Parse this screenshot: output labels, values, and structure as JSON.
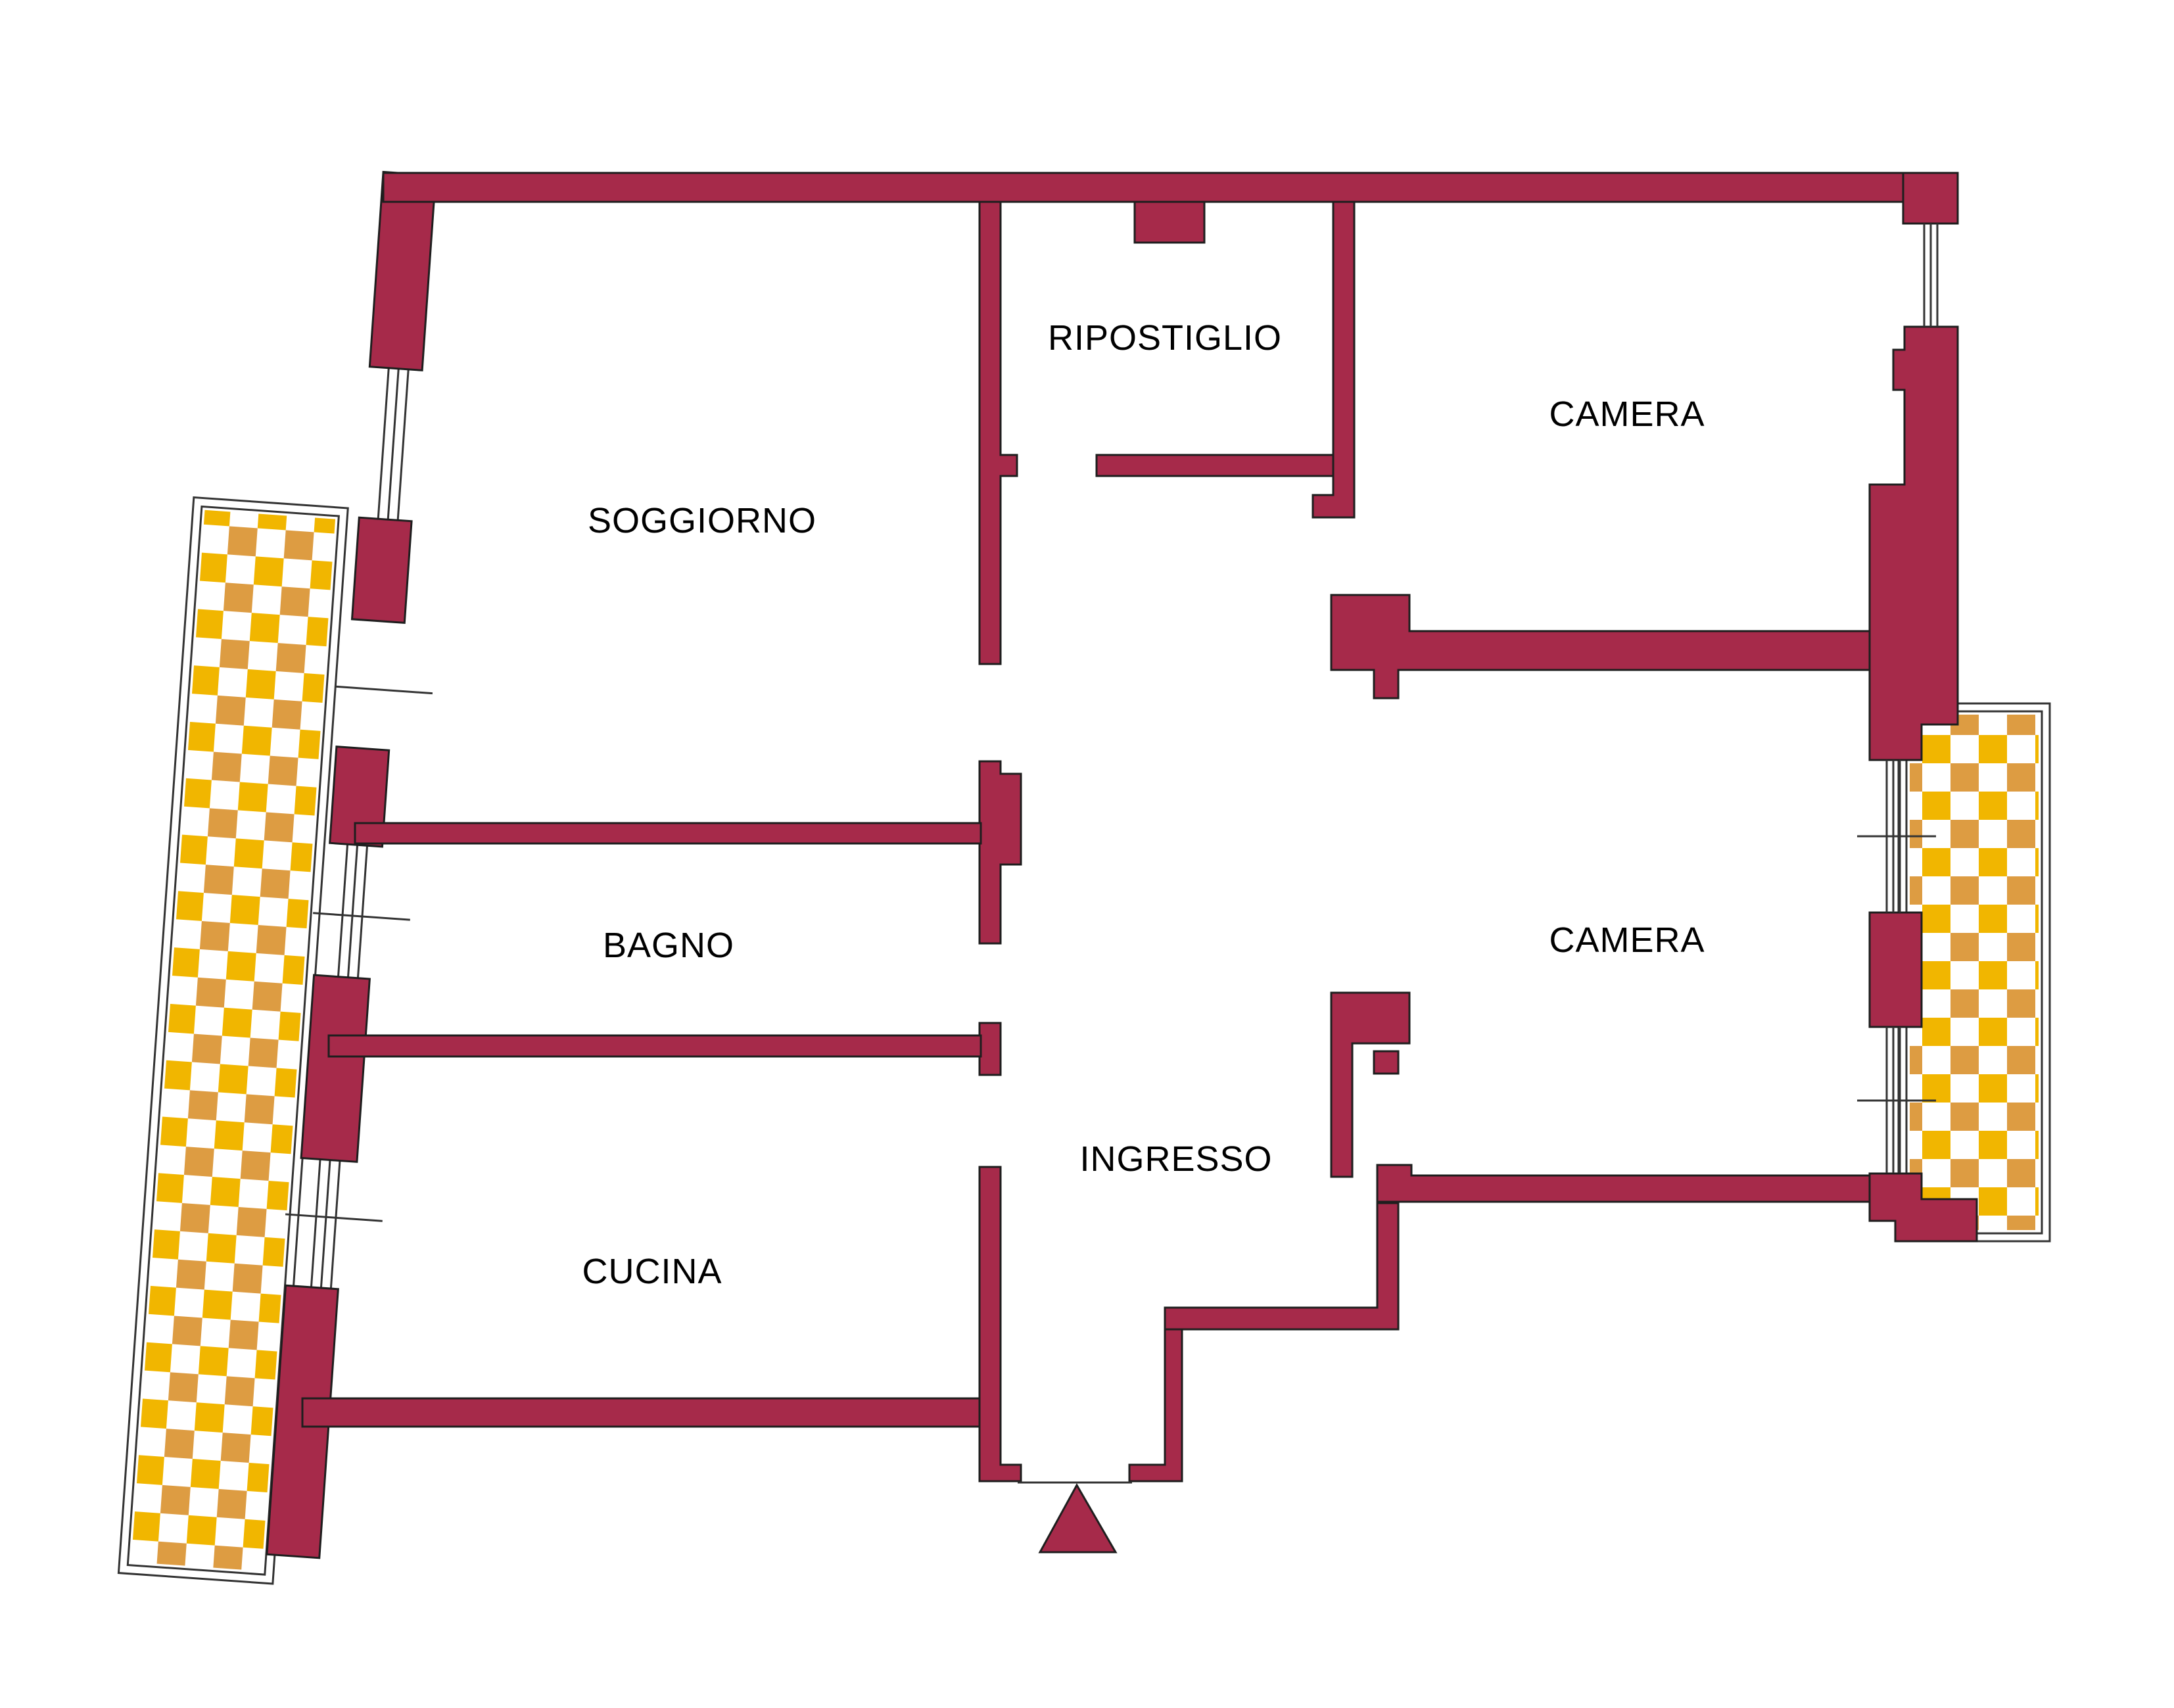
{
  "colors": {
    "wall": "#a62a4a",
    "outline": "#1e1e1e",
    "thin_line": "#333333",
    "balcony_yellow": "#f1b600",
    "balcony_orange": "#dd9c42",
    "text": "#000000",
    "background": "#ffffff"
  },
  "rooms": [
    {
      "id": "soggiorno",
      "label": "SOGGIORNO"
    },
    {
      "id": "ripostiglio",
      "label": "RIPOSTIGLIO"
    },
    {
      "id": "camera-nord",
      "label": "CAMERA"
    },
    {
      "id": "bagno",
      "label": "BAGNO"
    },
    {
      "id": "ingresso",
      "label": "INGRESSO"
    },
    {
      "id": "camera-sud",
      "label": "CAMERA"
    },
    {
      "id": "cucina",
      "label": "CUCINA"
    }
  ],
  "features": {
    "entrance_marker": "entrance-arrow",
    "balconies": [
      "balcony-left",
      "balcony-right"
    ]
  }
}
